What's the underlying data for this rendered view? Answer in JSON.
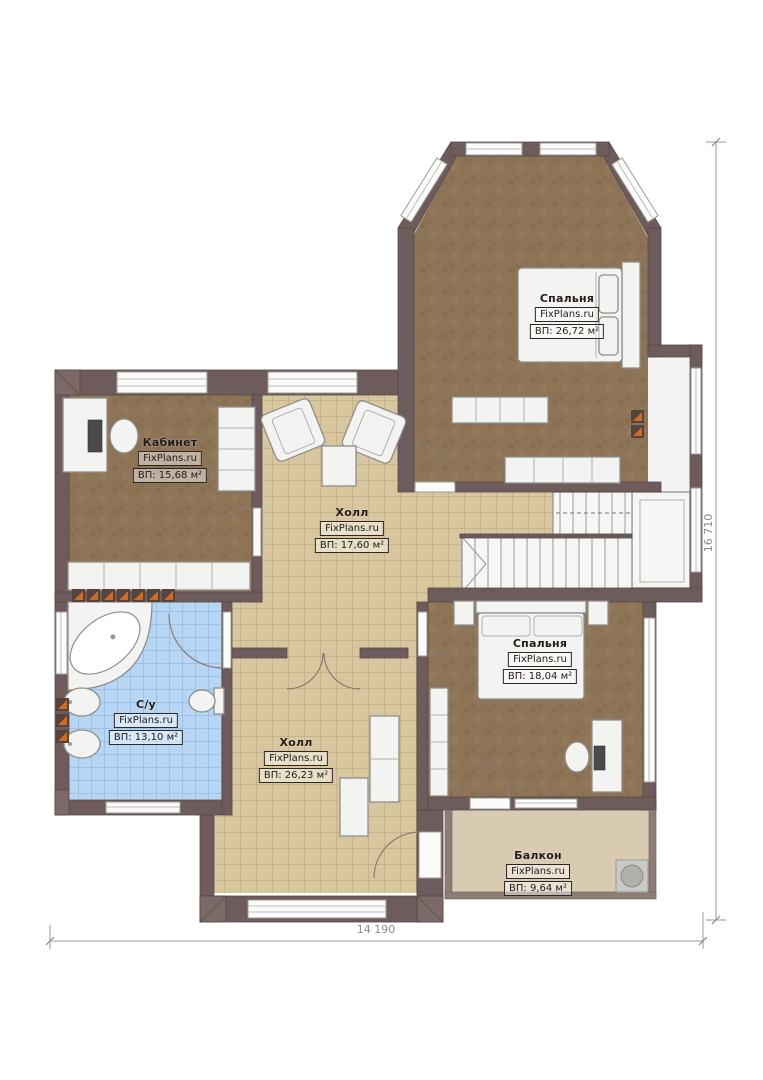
{
  "plan_title": "План этажа",
  "brand": "FixPlans.ru",
  "rooms": [
    {
      "id": "bedroom-top",
      "name": "Спальня",
      "brand": "FixPlans.ru",
      "area": "ВП: 26,72 м²"
    },
    {
      "id": "office",
      "name": "Кабинет",
      "brand": "FixPlans.ru",
      "area": "ВП: 15,68 м²"
    },
    {
      "id": "hall-upper",
      "name": "Холл",
      "brand": "FixPlans.ru",
      "area": "ВП: 17,60 м²"
    },
    {
      "id": "bedroom-right",
      "name": "Спальня",
      "brand": "FixPlans.ru",
      "area": "ВП: 18,04 м²"
    },
    {
      "id": "bathroom",
      "name": "С/у",
      "brand": "FixPlans.ru",
      "area": "ВП: 13,10 м²"
    },
    {
      "id": "hall-lower",
      "name": "Холл",
      "brand": "FixPlans.ru",
      "area": "ВП: 26,23 м²"
    },
    {
      "id": "balcony",
      "name": "Балкон",
      "brand": "FixPlans.ru",
      "area": "ВП: 9,64 м²"
    }
  ],
  "dimensions": {
    "width_label": "14 190",
    "height_label": "16 710"
  },
  "colors": {
    "wall": "#6d5c5b",
    "carpet": "#8d7456",
    "tile_beige": "#d8c79e",
    "tile_blue": "#b6d6f3",
    "balcony_floor": "#d9cbb1",
    "radiator_orange": "#d06a1e"
  }
}
